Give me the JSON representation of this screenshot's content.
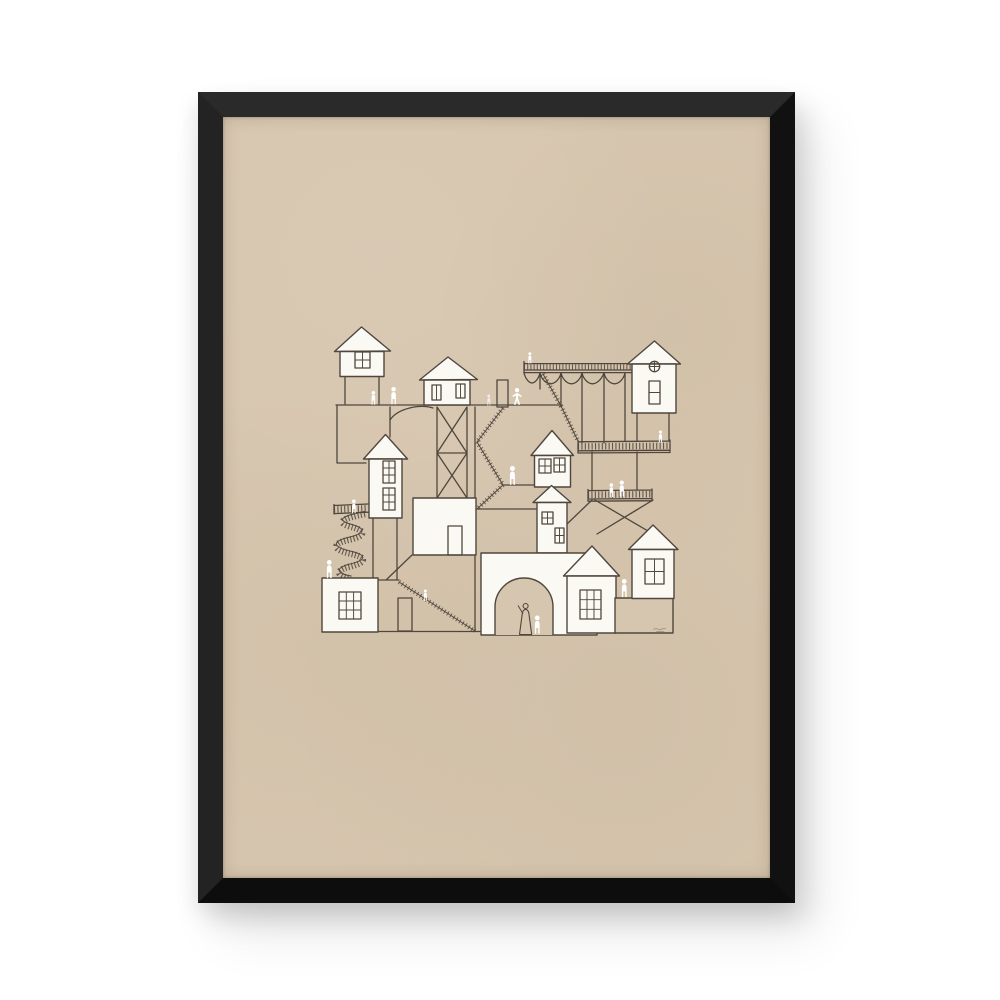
{
  "meta": {
    "title": "Framed poster — hand-drawn village of stacked houses",
    "description": "Product photo of a black-framed art print on a warm beige paper: a whimsical pen-and-ink illustration of little white houses connected by stilts, stairways, an arched viaduct, balconies, a round gateway arch and a spiral staircase, populated by tiny white figures and one robed figure under the arch.",
    "signature": "tiny illegible artist signature at lower right of drawing"
  },
  "colors": {
    "page_bg": "#ffffff",
    "frame": "#1b1b1b",
    "frame_edge_top": "#2a2a2a",
    "frame_edge_left": "#232323",
    "frame_edge_right": "#111111",
    "frame_edge_bottom": "#0d0d0d",
    "poster_bg": "#d7c6af",
    "line": "#4f473d",
    "house_fill": "#fbf9f3",
    "figure": "#ffffff",
    "robed_figure_fill": "#d7c6af",
    "signature_ink": "#8d8271"
  },
  "artwork": {
    "houses": 10,
    "white_figures": 14,
    "robed_figures": 1,
    "features": [
      "gable house on stilts",
      "house on x-braced tower",
      "arched viaduct with balustrade",
      "house with round window on stilts",
      "tall house with spiral staircase",
      "zigzag staircases",
      "balconies with railings",
      "round arch gateway with figures",
      "standalone doors",
      "pyramid roof house"
    ]
  }
}
